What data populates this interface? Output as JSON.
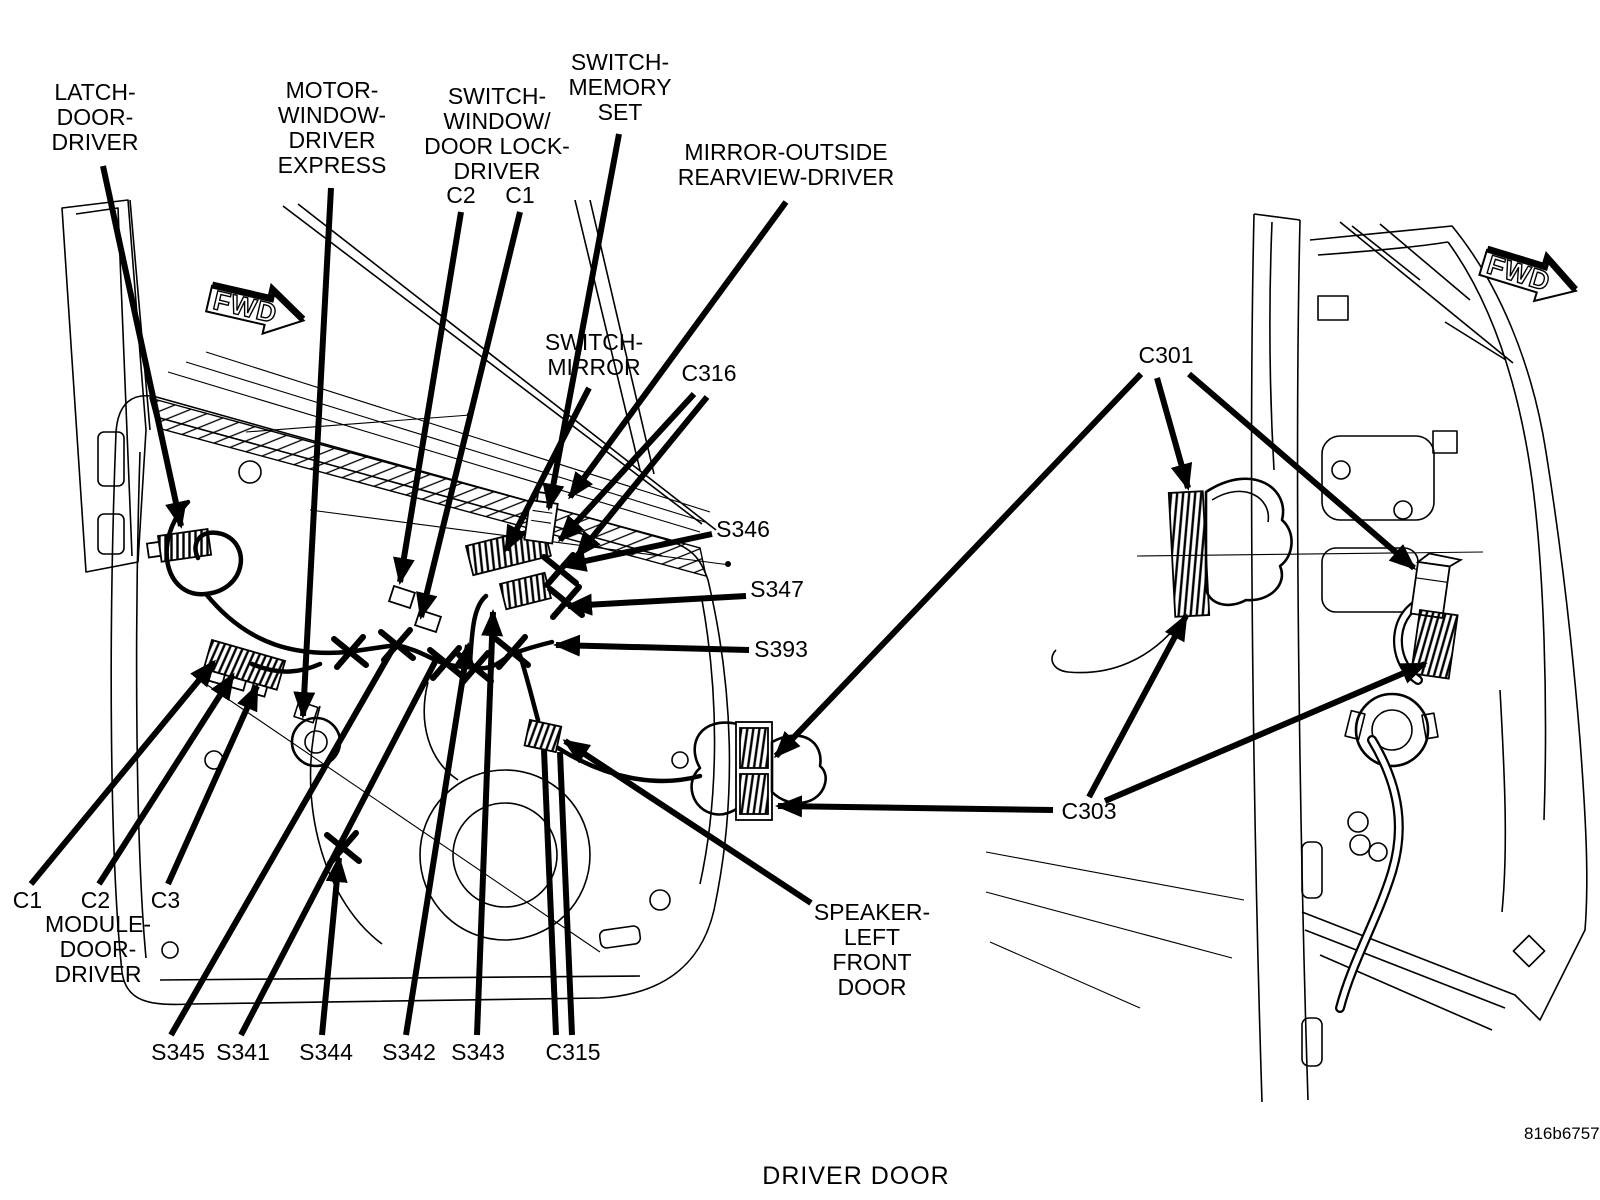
{
  "diagram": {
    "caption": "DRIVER DOOR",
    "figure_code": "816b6757",
    "fwd_label": "FWD",
    "labels": {
      "latch": "LATCH-\nDOOR-\nDRIVER",
      "motor": "MOTOR-\nWINDOW-\nDRIVER\nEXPRESS",
      "switch_window": "SWITCH-\nWINDOW/\nDOOR LOCK-\nDRIVER",
      "switch_window_c2": "C2",
      "switch_window_c1": "C1",
      "switch_memory": "SWITCH-\nMEMORY\nSET",
      "mirror_outside": "MIRROR-OUTSIDE\nREARVIEW-DRIVER",
      "switch_mirror": "SWITCH-\nMIRROR",
      "c316": "C316",
      "s346": "S346",
      "s347": "S347",
      "s393": "S393",
      "module_c1": "C1",
      "module_c2": "C2",
      "module_c3": "C3",
      "module": "MODULE-\nDOOR-\nDRIVER",
      "s345": "S345",
      "s341": "S341",
      "s344": "S344",
      "s342": "S342",
      "s343": "S343",
      "c315": "C315",
      "speaker": "SPEAKER-\nLEFT\nFRONT\nDOOR",
      "c301": "C301",
      "c303": "C303"
    }
  }
}
